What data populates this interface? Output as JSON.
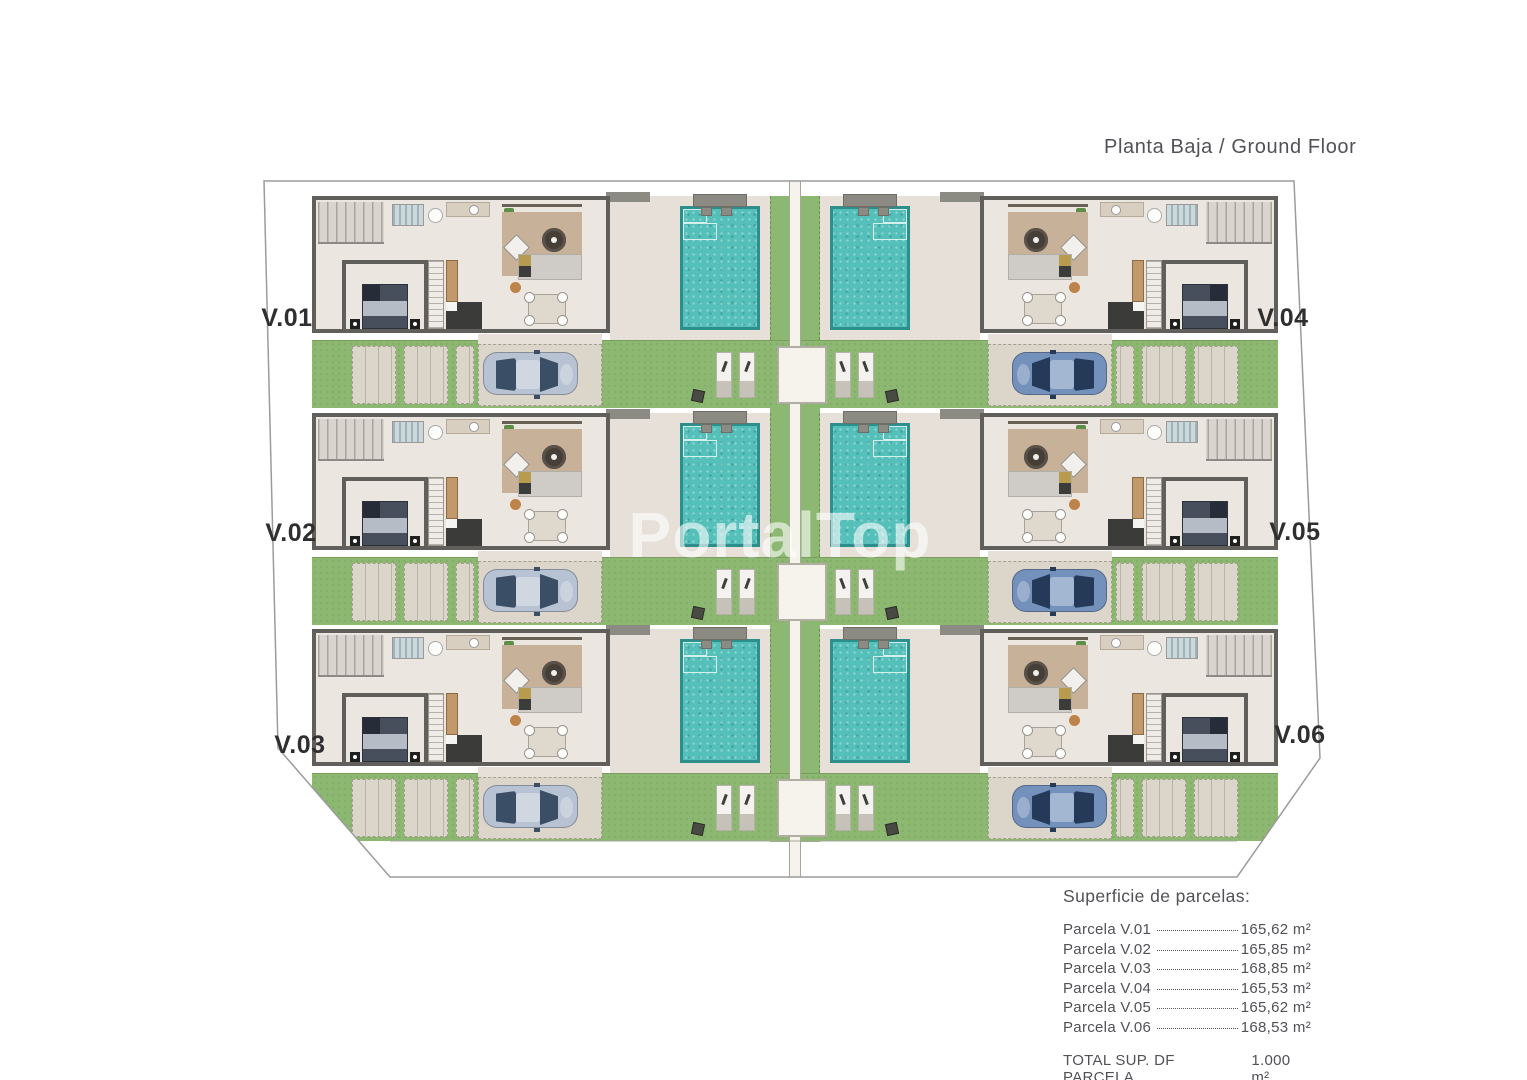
{
  "title": "Planta Baja / Ground Floor",
  "watermark": "PortalTop",
  "plan": {
    "villas": [
      {
        "id": "v01",
        "label": "V.01"
      },
      {
        "id": "v02",
        "label": "V.02"
      },
      {
        "id": "v03",
        "label": "V.03"
      },
      {
        "id": "v04",
        "label": "V.04"
      },
      {
        "id": "v05",
        "label": "V.05"
      },
      {
        "id": "v06",
        "label": "V.06"
      }
    ]
  },
  "legend": {
    "heading": "Superficie de parcelas:",
    "rows": [
      {
        "label": "Parcela V.01",
        "value": "165,62 m²"
      },
      {
        "label": "Parcela V.02",
        "value": "165,85 m²"
      },
      {
        "label": "Parcela V.03",
        "value": "168,85 m²"
      },
      {
        "label": "Parcela V.04",
        "value": "165,53 m²"
      },
      {
        "label": "Parcela V.05",
        "value": "165,62 m²"
      },
      {
        "label": "Parcela V.06",
        "value": "168,53 m²"
      }
    ],
    "total": {
      "label": "TOTAL SUP. DF PARCELA",
      "value": "1.000 m²"
    }
  },
  "colors": {
    "grass": "#8db872",
    "pool_water": "#55bfba",
    "pool_border": "#2d8f8b",
    "pavement": "#e6e0d8",
    "house_floor": "#ebe6e0",
    "wall": "#605f5b",
    "path": "#f6f3ec",
    "car_left": "#b7c2d2",
    "car_right": "#7391bb",
    "text": "#515156",
    "label_text": "#2f2f2f"
  }
}
